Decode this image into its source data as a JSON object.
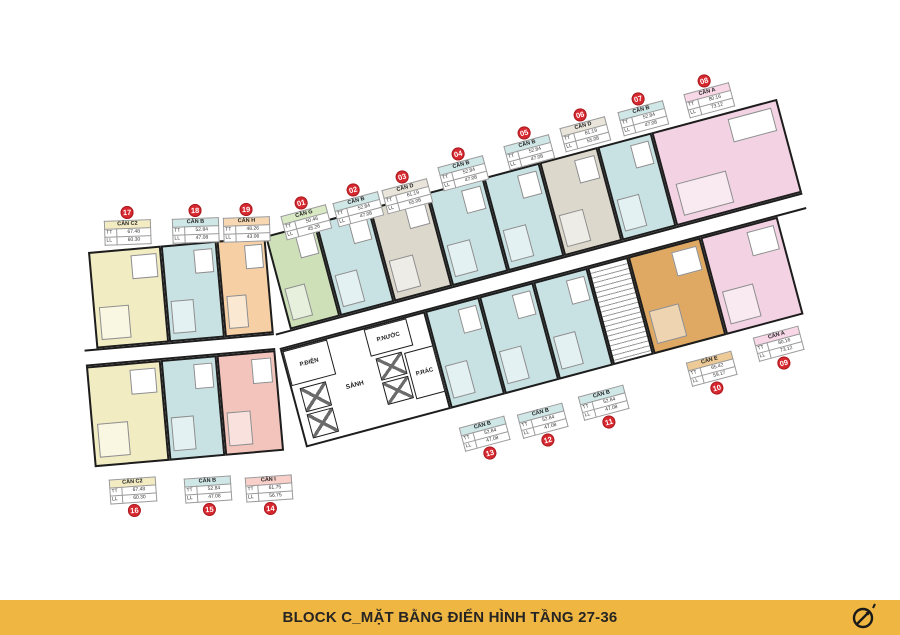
{
  "title_bar": {
    "text": "BLOCK C_MẶT BẰNG ĐIỂN HÌNH TẦNG 27-36",
    "bg_color": "#EFB742",
    "text_color": "#262524"
  },
  "area_row_labels": {
    "tt": "TT",
    "ll": "LL"
  },
  "core_rooms": {
    "electrical": "P.ĐIỆN",
    "water": "P.NƯỚC",
    "lobby": "SẢNH",
    "trash": "P.RÁC"
  },
  "unit_colors": {
    "A": "#f3d3e3",
    "B": "#c8e2e4",
    "C2": "#f2ecc2",
    "D": "#ddd8cc",
    "E": "#dfa964",
    "G": "#cde0b8",
    "H": "#f6d0a4",
    "I": "#f3c4bc",
    "wall": "#1d1d1d",
    "badge": "#d7282f",
    "corridor": "#ffffff"
  },
  "labels": [
    {
      "num": "01",
      "name": "CĂN G",
      "tt": "50.46",
      "ll": "45.26"
    },
    {
      "num": "02",
      "name": "CĂN B",
      "tt": "52.84",
      "ll": "47.08"
    },
    {
      "num": "03",
      "name": "CĂN D",
      "tt": "61.19",
      "ll": "55.08"
    },
    {
      "num": "04",
      "name": "CĂN B",
      "tt": "52.84",
      "ll": "47.08"
    },
    {
      "num": "05",
      "name": "CĂN B",
      "tt": "52.84",
      "ll": "47.08"
    },
    {
      "num": "06",
      "name": "CĂN D",
      "tt": "61.19",
      "ll": "55.08"
    },
    {
      "num": "07",
      "name": "CĂN B",
      "tt": "52.84",
      "ll": "47.08"
    },
    {
      "num": "08",
      "name": "CĂN A",
      "tt": "80.16",
      "ll": "73.12"
    },
    {
      "num": "09",
      "name": "CĂN A",
      "tt": "80.16",
      "ll": "73.12"
    },
    {
      "num": "10",
      "name": "CĂN E",
      "tt": "65.42",
      "ll": "59.17"
    },
    {
      "num": "11",
      "name": "CĂN B",
      "tt": "52.84",
      "ll": "47.08"
    },
    {
      "num": "12",
      "name": "CĂN B",
      "tt": "52.84",
      "ll": "47.08"
    },
    {
      "num": "13",
      "name": "CĂN B",
      "tt": "52.84",
      "ll": "47.08"
    },
    {
      "num": "14",
      "name": "CĂN I",
      "tt": "61.75",
      "ll": "56.75"
    },
    {
      "num": "15",
      "name": "CĂN B",
      "tt": "52.84",
      "ll": "47.08"
    },
    {
      "num": "16",
      "name": "CĂN C2",
      "tt": "67.48",
      "ll": "60.30"
    },
    {
      "num": "17",
      "name": "CĂN C2",
      "tt": "67.48",
      "ll": "60.30"
    },
    {
      "num": "18",
      "name": "CĂN B",
      "tt": "52.84",
      "ll": "47.08"
    },
    {
      "num": "19",
      "name": "CĂN H",
      "tt": "48.26",
      "ll": "43.06"
    }
  ]
}
